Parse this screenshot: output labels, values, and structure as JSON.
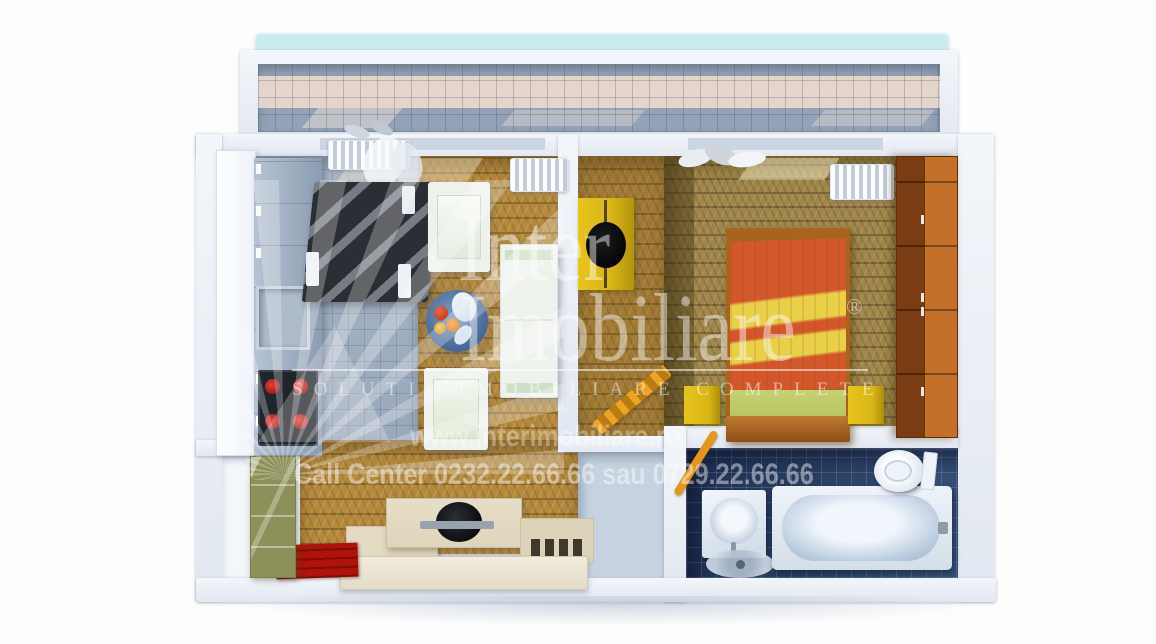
{
  "watermark": {
    "brand_word_top": "Inter",
    "brand_word_bottom": "Imobiliare",
    "registered_symbol": "®",
    "tagline": "SOLUTII IMOBILIARE COMPLETE",
    "website": "www.interimobiliare.ro",
    "call_center": "Call Center 0232.22.66.66 sau 0729.22.66.66"
  },
  "colors": {
    "floor_wood": "#b5893c",
    "floor_wood_dark": "#8f6a2a",
    "floor_bedroom": "#a08648",
    "floor_bedroom_dark": "#7d6535",
    "floor_kitchen_tile": "#9aa8bc",
    "floor_bath_tile": "#2f4468",
    "wall_white": "#edf1f7",
    "balcony_tile": "#93a2b6",
    "balcony_pink": "#ecd9ce",
    "balcony_teal": "#c9edee",
    "sofa_dark": "#2b2e34",
    "seat_white": "#eef2ec",
    "bed_orange": "#d2572b",
    "bed_yellow": "#e8d049",
    "bed_green": "#b9c660",
    "bed_frame": "#a8641f",
    "nightstand_yellow": "#d8b516",
    "wardrobe_dark": "#7a3c12",
    "wardrobe_light": "#c4702a",
    "rug_red": "#b01408",
    "cabinet_green": "#8d9159",
    "tv_unit_cream": "#ded5bc",
    "stove_red": "#b32020",
    "walkway_gray": "#c6d2e0"
  }
}
